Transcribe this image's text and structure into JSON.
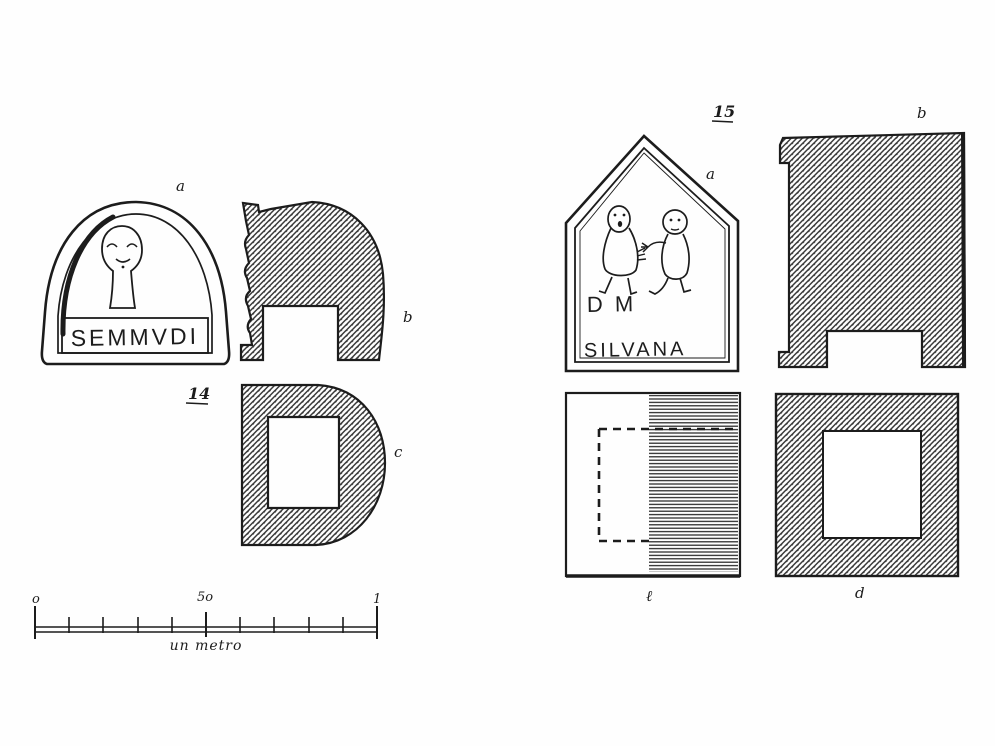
{
  "fig14": {
    "number": "14",
    "labels": {
      "a": "a",
      "b": "b",
      "c": "c"
    },
    "inscription": "SEMMVDI"
  },
  "fig15": {
    "number": "15",
    "labels": {
      "a": "a",
      "b": "b",
      "l": "ℓ",
      "d": "d"
    },
    "inscription_line1": "D M",
    "inscription_line2": "SILVANA"
  },
  "scale": {
    "start": "o",
    "mid": "5o",
    "end": "1",
    "caption": "un metro"
  },
  "colors": {
    "ink": "#1c1c1c",
    "paper": "#ffffff",
    "hatch": "#3a3a3a"
  }
}
